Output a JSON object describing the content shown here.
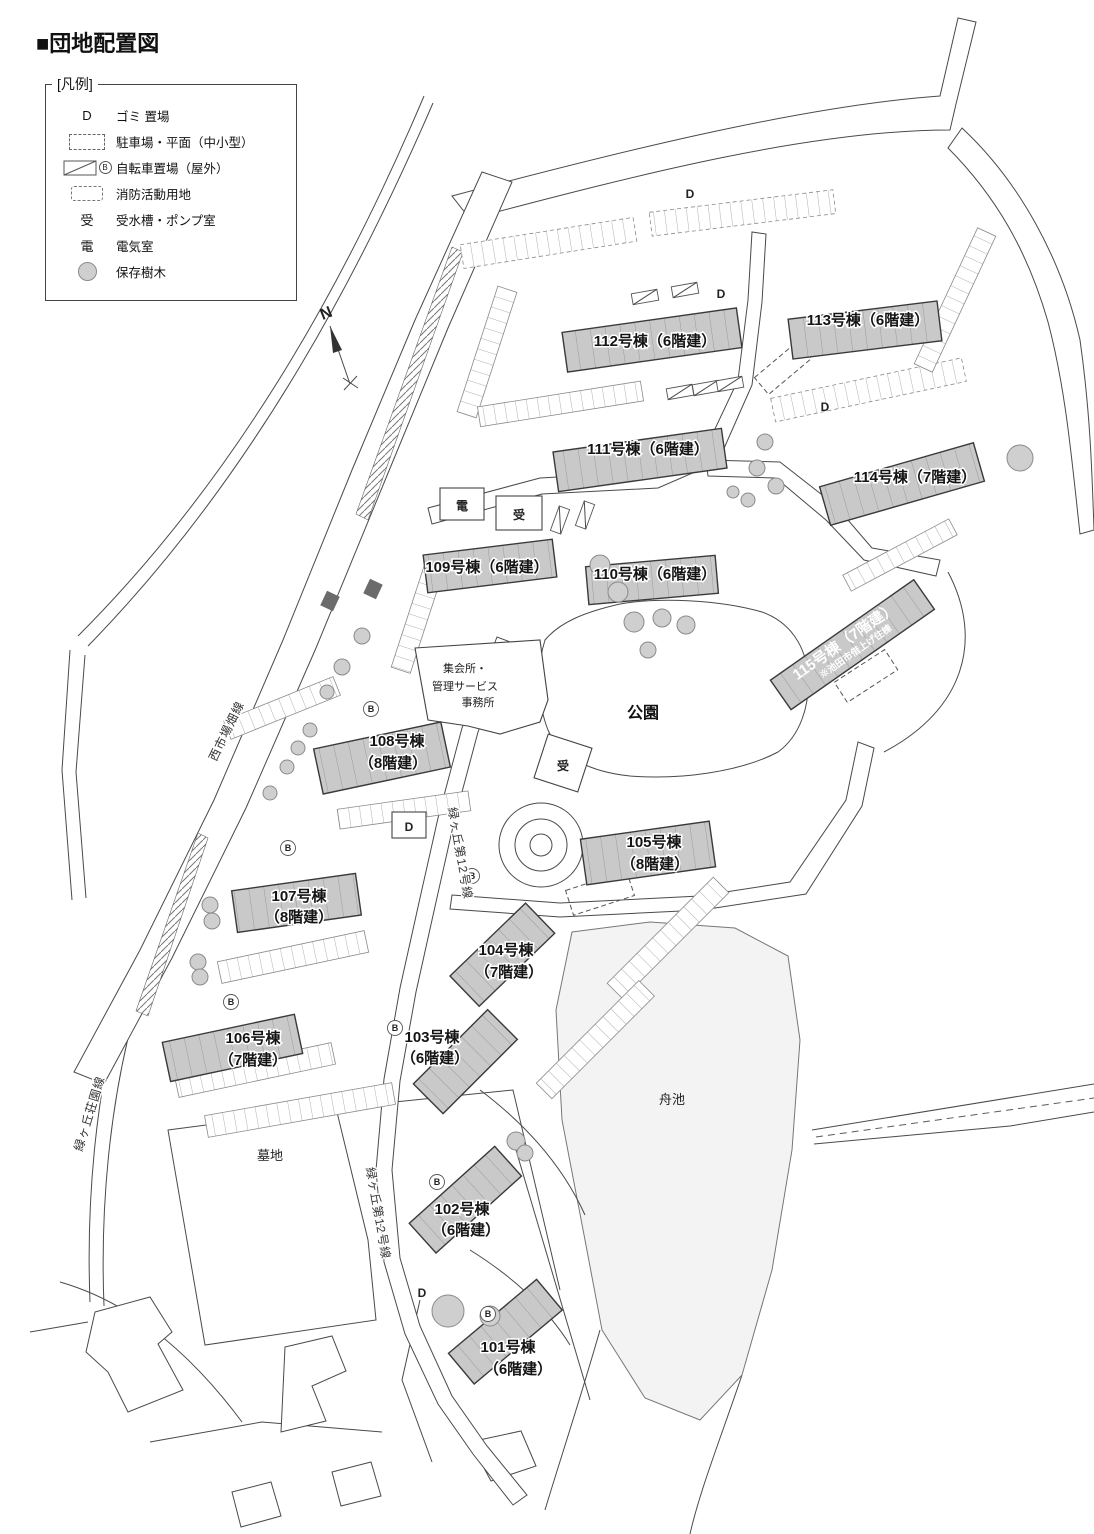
{
  "title": "■団地配置図",
  "legend": {
    "title": "[凡例]",
    "items": [
      {
        "symbol": "D",
        "label": "ゴミ 置場"
      },
      {
        "symbol": "parking-rect",
        "label": "駐車場・平面（中小型）"
      },
      {
        "symbol": "bicycle-rect",
        "label": "自転車置場（屋外）",
        "badge": "B"
      },
      {
        "symbol": "fire-rect",
        "label": "消防活動用地"
      },
      {
        "symbol": "受",
        "label": "受水槽・ポンプ室"
      },
      {
        "symbol": "電",
        "label": "電気室"
      },
      {
        "symbol": "tree-circle",
        "label": "保存樹木"
      }
    ]
  },
  "compass": {
    "label": "N"
  },
  "map": {
    "areas": {
      "park": "公園",
      "pond": "舟池",
      "cemetery": "墓地",
      "office1": "集会所・",
      "office2": "管理サービス",
      "office3": "事務所"
    },
    "roads": [
      {
        "name": "西市場畑線"
      },
      {
        "name": "緑ヶ丘第12号線"
      },
      {
        "name": "緑ヶ丘第12号線"
      },
      {
        "name": "緑ヶ丘荘園線"
      }
    ],
    "markers": {
      "garbage": "D",
      "bicycle": "B",
      "water": "受",
      "electric": "電"
    },
    "buildings": [
      {
        "id": "101",
        "line1": "101号棟",
        "line2": "（6階建）"
      },
      {
        "id": "102",
        "line1": "102号棟",
        "line2": "（6階建）"
      },
      {
        "id": "103",
        "line1": "103号棟",
        "line2": "（6階建）"
      },
      {
        "id": "104",
        "line1": "104号棟",
        "line2": "（7階建）"
      },
      {
        "id": "105",
        "line1": "105号棟",
        "line2": "（8階建）"
      },
      {
        "id": "106",
        "line1": "106号棟",
        "line2": "（7階建）"
      },
      {
        "id": "107",
        "line1": "107号棟",
        "line2": "（8階建）"
      },
      {
        "id": "108",
        "line1": "108号棟",
        "line2": "（8階建）"
      },
      {
        "id": "109",
        "line1": "109号棟（6階建）",
        "line2": ""
      },
      {
        "id": "110",
        "line1": "110号棟（6階建）",
        "line2": ""
      },
      {
        "id": "111",
        "line1": "111号棟（6階建）",
        "line2": ""
      },
      {
        "id": "112",
        "line1": "112号棟（6階建）",
        "line2": ""
      },
      {
        "id": "113",
        "line1": "113号棟（6階建）",
        "line2": ""
      },
      {
        "id": "114",
        "line1": "114号棟（7階建）",
        "line2": ""
      },
      {
        "id": "115",
        "line1": "115号棟（7階建）",
        "line2": "※池田市借上げ住棟"
      }
    ]
  },
  "colors": {
    "building_fill": "#c9c9c9",
    "pond_fill": "#f3f3f3",
    "tree_fill": "#cfcfcf",
    "line": "#3a3a3a"
  }
}
